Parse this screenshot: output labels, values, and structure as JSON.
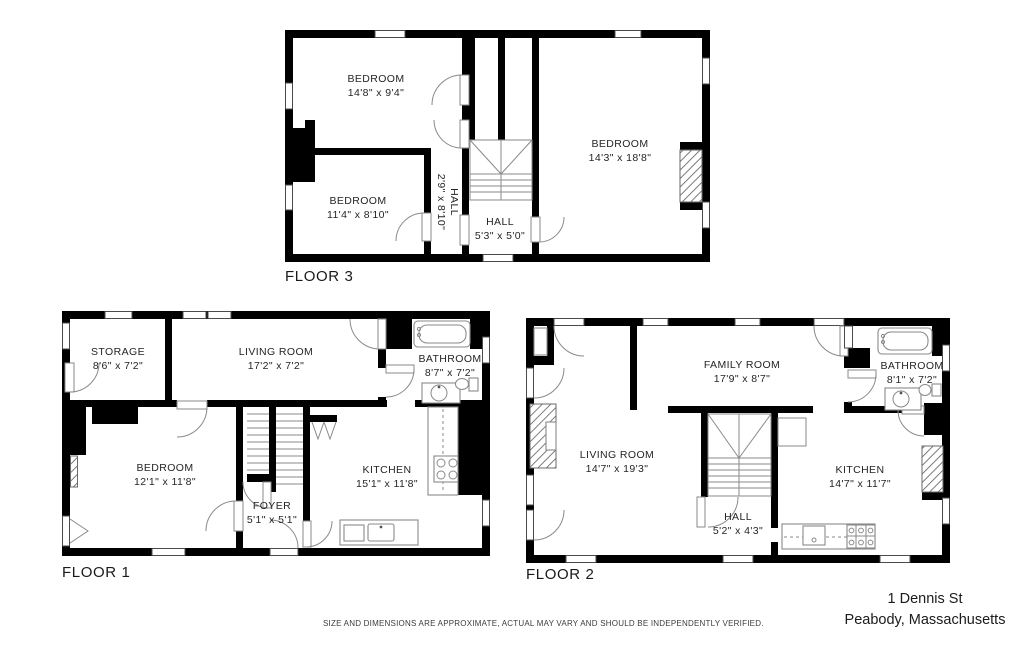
{
  "page": {
    "background": "#ffffff",
    "wall_color": "#000000"
  },
  "floor3": {
    "label": "FLOOR 3",
    "bedroom1": {
      "name": "BEDROOM",
      "dims": "14'8\" x 9'4\""
    },
    "bedroom2": {
      "name": "BEDROOM",
      "dims": "11'4\" x 8'10\""
    },
    "hall_upper": {
      "name": "HALL",
      "dims": "2'9\" x 8'10\""
    },
    "hall_lower": {
      "name": "HALL",
      "dims": "5'3\" x 5'0\""
    },
    "bedroom3": {
      "name": "BEDROOM",
      "dims": "14'3\" x 18'8\""
    }
  },
  "floor1": {
    "label": "FLOOR 1",
    "storage": {
      "name": "STORAGE",
      "dims": "8'6\" x 7'2\""
    },
    "living_room": {
      "name": "LIVING ROOM",
      "dims": "17'2\" x 7'2\""
    },
    "bathroom": {
      "name": "BATHROOM",
      "dims": "8'7\" x 7'2\""
    },
    "bedroom": {
      "name": "BEDROOM",
      "dims": "12'1\" x 11'8\""
    },
    "foyer": {
      "name": "FOYER",
      "dims": "5'1\" x 5'1\""
    },
    "kitchen": {
      "name": "KITCHEN",
      "dims": "15'1\" x 11'8\""
    }
  },
  "floor2": {
    "label": "FLOOR 2",
    "family_room": {
      "name": "FAMILY ROOM",
      "dims": "17'9\" x 8'7\""
    },
    "bathroom": {
      "name": "BATHROOM",
      "dims": "8'1\" x 7'2\""
    },
    "living_room": {
      "name": "LIVING ROOM",
      "dims": "14'7\" x 19'3\""
    },
    "hall": {
      "name": "HALL",
      "dims": "5'2\" x 4'3\""
    },
    "kitchen": {
      "name": "KITCHEN",
      "dims": "14'7\" x 11'7\""
    }
  },
  "footer": {
    "disclaimer": "SIZE AND DIMENSIONS ARE APPROXIMATE, ACTUAL MAY VARY AND SHOULD BE INDEPENDENTLY VERIFIED.",
    "address_line1": "1 Dennis St",
    "address_line2": "Peabody, Massachusetts"
  }
}
